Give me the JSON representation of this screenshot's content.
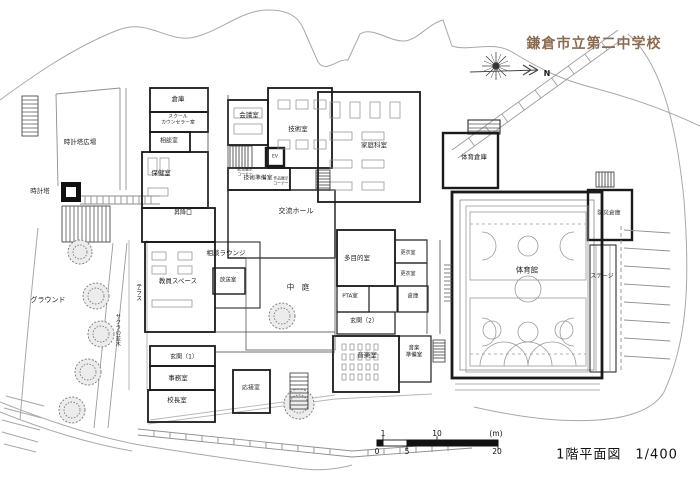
{
  "title": {
    "text": "鎌倉市立第二中学校",
    "color": "#8b6b4f",
    "x": 594,
    "y": 43
  },
  "caption": {
    "text": "1階平面図　1/400",
    "x": 617,
    "y": 453
  },
  "compass": {
    "north_label": "N"
  },
  "scale_bar": {
    "unit_note": "(m)",
    "top_ticks": [
      {
        "t": "1",
        "x": 383
      },
      {
        "t": "10",
        "x": 437
      },
      {
        "t": "(m)",
        "x": 496
      }
    ],
    "bottom_ticks": [
      {
        "t": "0",
        "x": 377
      },
      {
        "t": "5",
        "x": 407
      },
      {
        "t": "20",
        "x": 497
      }
    ],
    "top_y": 429,
    "bottom_y": 447
  },
  "colors": {
    "wall": "#1a1a1a",
    "contour": "#a8a8a8",
    "court": "#9a9a9a",
    "title": "#8b6b4f"
  },
  "plan": {
    "labels": [
      {
        "name": "room-label-souko-a",
        "text": "倉庫",
        "x": 178,
        "y": 100,
        "size": 6.5
      },
      {
        "name": "room-label-counselor",
        "lines": [
          "スクール",
          "カウンセラー室"
        ],
        "x": 178,
        "y": 120,
        "size": 4.8
      },
      {
        "name": "room-label-soudan",
        "text": "相談室",
        "x": 169,
        "y": 141,
        "size": 6
      },
      {
        "name": "room-label-hoken",
        "text": "保健室",
        "x": 161,
        "y": 174,
        "size": 6.5
      },
      {
        "name": "room-label-kaigi",
        "text": "会議室",
        "x": 249,
        "y": 116,
        "size": 6.5
      },
      {
        "name": "room-label-gijutsu",
        "text": "技術室",
        "x": 298,
        "y": 130,
        "size": 6.5
      },
      {
        "name": "room-label-ev",
        "text": "EV",
        "x": 275,
        "y": 157,
        "size": 4.5
      },
      {
        "name": "room-label-kinen-corner",
        "lines": [
          "記念展示",
          "コーナー"
        ],
        "x": 245,
        "y": 172,
        "size": 3.8
      },
      {
        "name": "room-label-sakuhin-corner",
        "lines": [
          "作品展示",
          "コーナー"
        ],
        "x": 281,
        "y": 181,
        "size": 3.8
      },
      {
        "name": "room-label-gijutsu-junbi",
        "text": "技術準備室",
        "x": 258,
        "y": 179,
        "size": 5.8
      },
      {
        "name": "room-label-kateika",
        "text": "家庭科室",
        "x": 374,
        "y": 146,
        "size": 6.5
      },
      {
        "name": "room-label-kouryu-hall",
        "text": "交流ホール",
        "x": 296,
        "y": 211,
        "size": 7
      },
      {
        "name": "room-label-shoukouguchi",
        "text": "昇降口",
        "x": 183,
        "y": 213,
        "size": 6
      },
      {
        "name": "room-label-soudan-lounge",
        "text": "相談ラウンジ",
        "x": 226,
        "y": 254,
        "size": 6.5
      },
      {
        "name": "room-label-kyouin-space",
        "text": "教員スペース",
        "x": 178,
        "y": 282,
        "size": 6.5
      },
      {
        "name": "room-label-housou",
        "text": "放送室",
        "x": 228,
        "y": 281,
        "size": 5.5
      },
      {
        "name": "room-label-nakaniwa",
        "text": "中　庭",
        "x": 298,
        "y": 287,
        "size": 7.5
      },
      {
        "name": "room-label-tamokuteki",
        "text": "多目的室",
        "x": 357,
        "y": 259,
        "size": 6.5
      },
      {
        "name": "room-label-koui-1",
        "text": "更衣室",
        "x": 408,
        "y": 253,
        "size": 5
      },
      {
        "name": "room-label-koui-2",
        "text": "更衣室",
        "x": 408,
        "y": 274,
        "size": 5
      },
      {
        "name": "room-label-pta",
        "text": "PTA室",
        "x": 350,
        "y": 297,
        "size": 5.5
      },
      {
        "name": "room-label-souko-e",
        "text": "倉庫",
        "x": 413,
        "y": 297,
        "size": 5.5
      },
      {
        "name": "room-label-genkan-2",
        "text": "玄関（2）",
        "x": 364,
        "y": 321,
        "size": 6
      },
      {
        "name": "room-label-ongaku",
        "text": "音楽室",
        "x": 367,
        "y": 356,
        "size": 6.5
      },
      {
        "name": "room-label-ongaku-junbi",
        "lines": [
          "音楽",
          "準備室"
        ],
        "x": 414,
        "y": 352,
        "size": 5.5
      },
      {
        "name": "room-label-taiiku-souko",
        "text": "体育倉庫",
        "x": 474,
        "y": 158,
        "size": 6.5
      },
      {
        "name": "room-label-taiikukan",
        "text": "体育館",
        "x": 527,
        "y": 270,
        "size": 7.5
      },
      {
        "name": "room-label-bousai-souko",
        "text": "防災倉庫",
        "x": 609,
        "y": 214,
        "size": 5.8
      },
      {
        "name": "room-label-stage",
        "text": "ステージ",
        "x": 602,
        "y": 277,
        "size": 5.8
      },
      {
        "name": "room-label-genkan-1",
        "text": "玄関（1）",
        "x": 184,
        "y": 357,
        "size": 6
      },
      {
        "name": "room-label-jimu",
        "text": "事務室",
        "x": 178,
        "y": 379,
        "size": 6.5
      },
      {
        "name": "room-label-kouchou",
        "text": "校長室",
        "x": 177,
        "y": 401,
        "size": 6.5
      },
      {
        "name": "room-label-ousetsu",
        "text": "応接室",
        "x": 251,
        "y": 388,
        "size": 6
      },
      {
        "name": "site-label-tokeitou-hiroba",
        "text": "時計塔広場",
        "x": 80,
        "y": 143,
        "size": 6.5
      },
      {
        "name": "site-label-tokeitou",
        "text": "時計塔",
        "x": 40,
        "y": 192,
        "size": 6.5
      },
      {
        "name": "site-label-ground",
        "text": "グラウンド",
        "x": 48,
        "y": 300,
        "size": 7
      },
      {
        "name": "site-label-terrace",
        "text": "テラス",
        "x": 138,
        "y": 292,
        "size": 6,
        "vertical": true
      },
      {
        "name": "site-label-sakura",
        "text": "サクラの並木",
        "x": 117,
        "y": 330,
        "size": 5.5,
        "vertical": true
      },
      {
        "name": "north-label",
        "text": "N",
        "x": 547,
        "y": 74,
        "size": 8,
        "bold": true
      }
    ]
  }
}
